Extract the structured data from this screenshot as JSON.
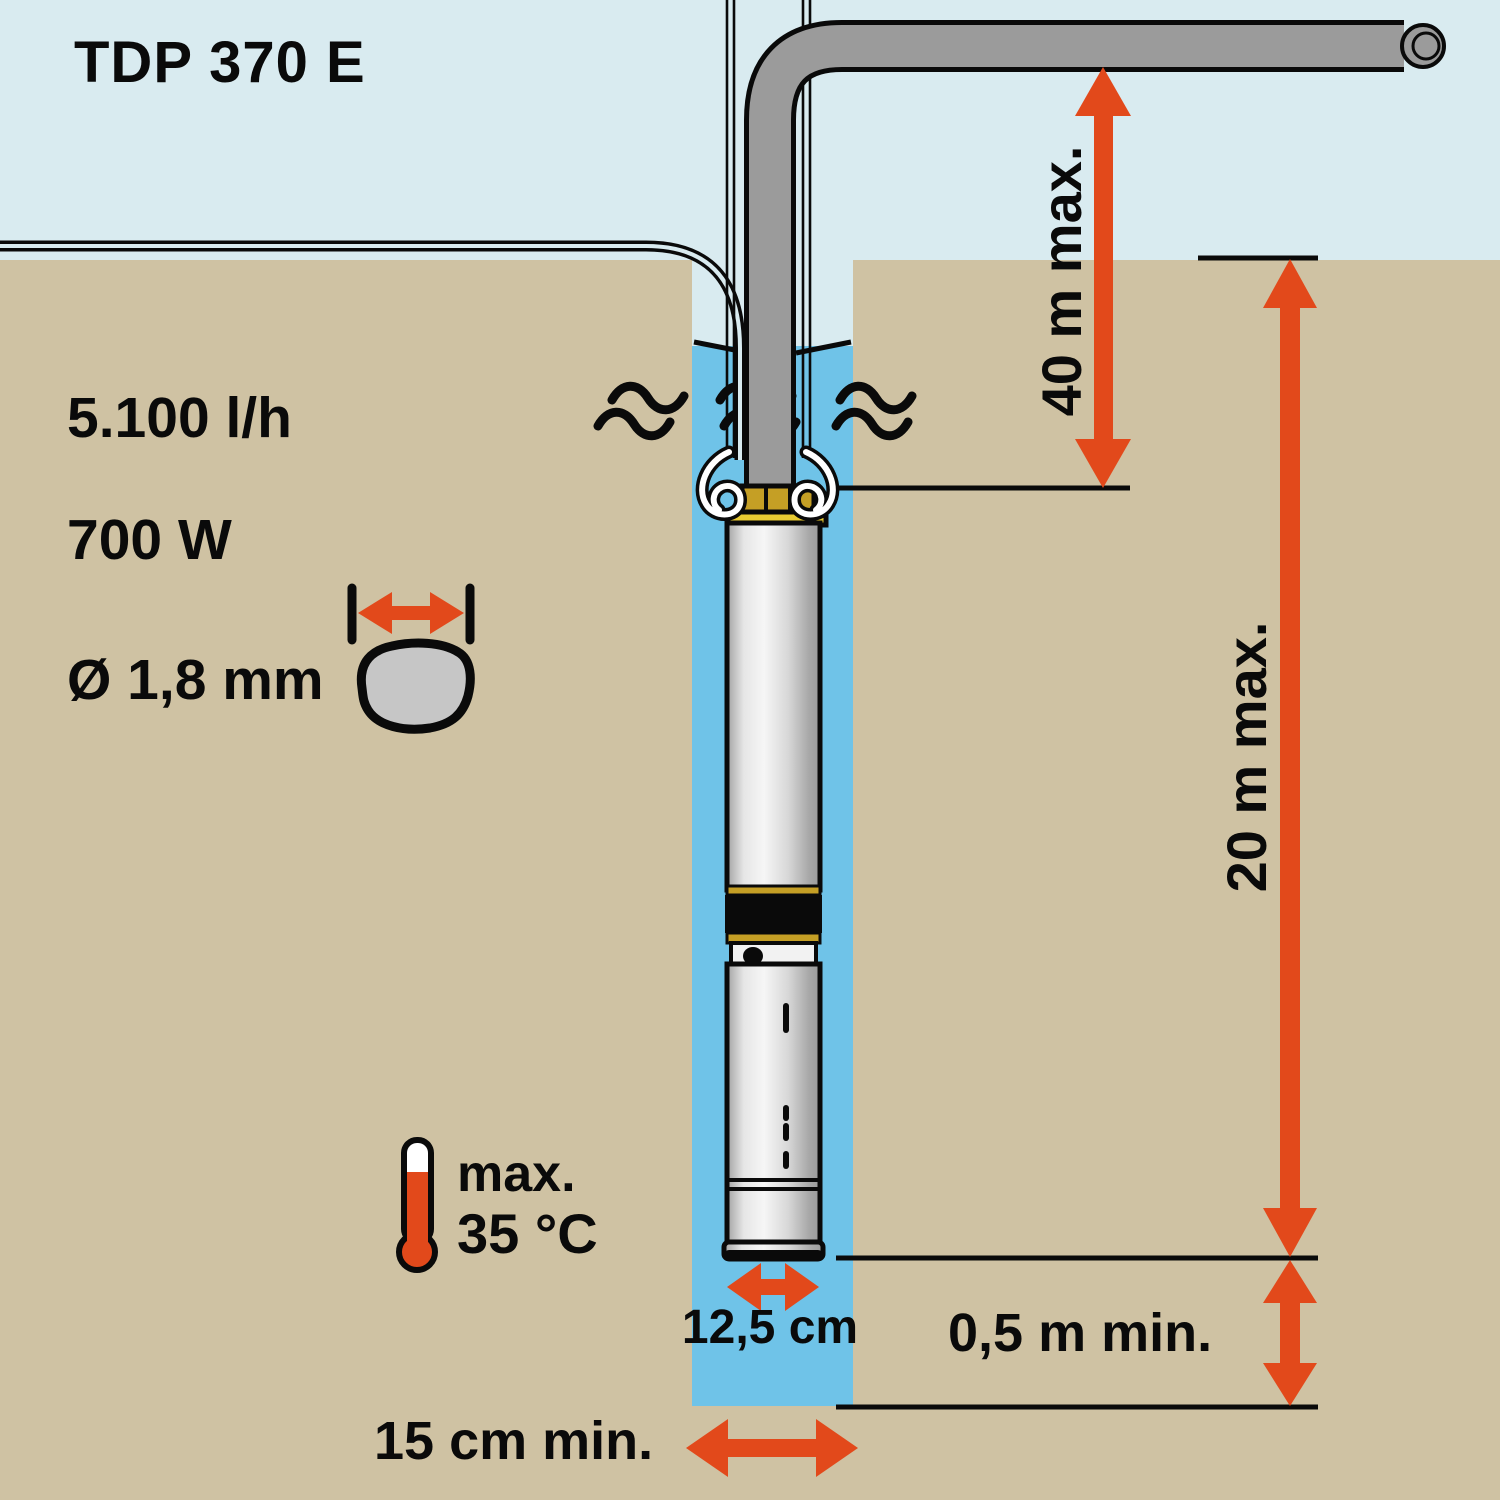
{
  "title": "TDP 370 E",
  "specs": {
    "flow_rate": "5.100 l/h",
    "power": "700 W",
    "grain_size": "Ø 1,8 mm"
  },
  "temperature": {
    "prefix": "max.",
    "value": "35 °C"
  },
  "dimensions": {
    "delivery_head": "40 m max.",
    "immersion_depth": "20 m max.",
    "bottom_clearance": "0,5 m min.",
    "pump_diameter": "12,5 cm",
    "well_diameter": "15 cm min."
  },
  "icons": {
    "thermometer": "thermometer-icon",
    "grain": "grain-icon",
    "diameter_arrow": "diameter-arrow-icon",
    "water_waves": "wave-icon",
    "dimension_arrows": "orange double-headed arrows"
  },
  "colors": {
    "accent_orange": "#e2491b",
    "sky": "#d9ebf0",
    "ground": "#cfc2a3",
    "water": "#6fc3e8",
    "pipe_gray": "#9b9b9b",
    "brass": "#c59f25",
    "outline_black": "#0a0a0a"
  }
}
